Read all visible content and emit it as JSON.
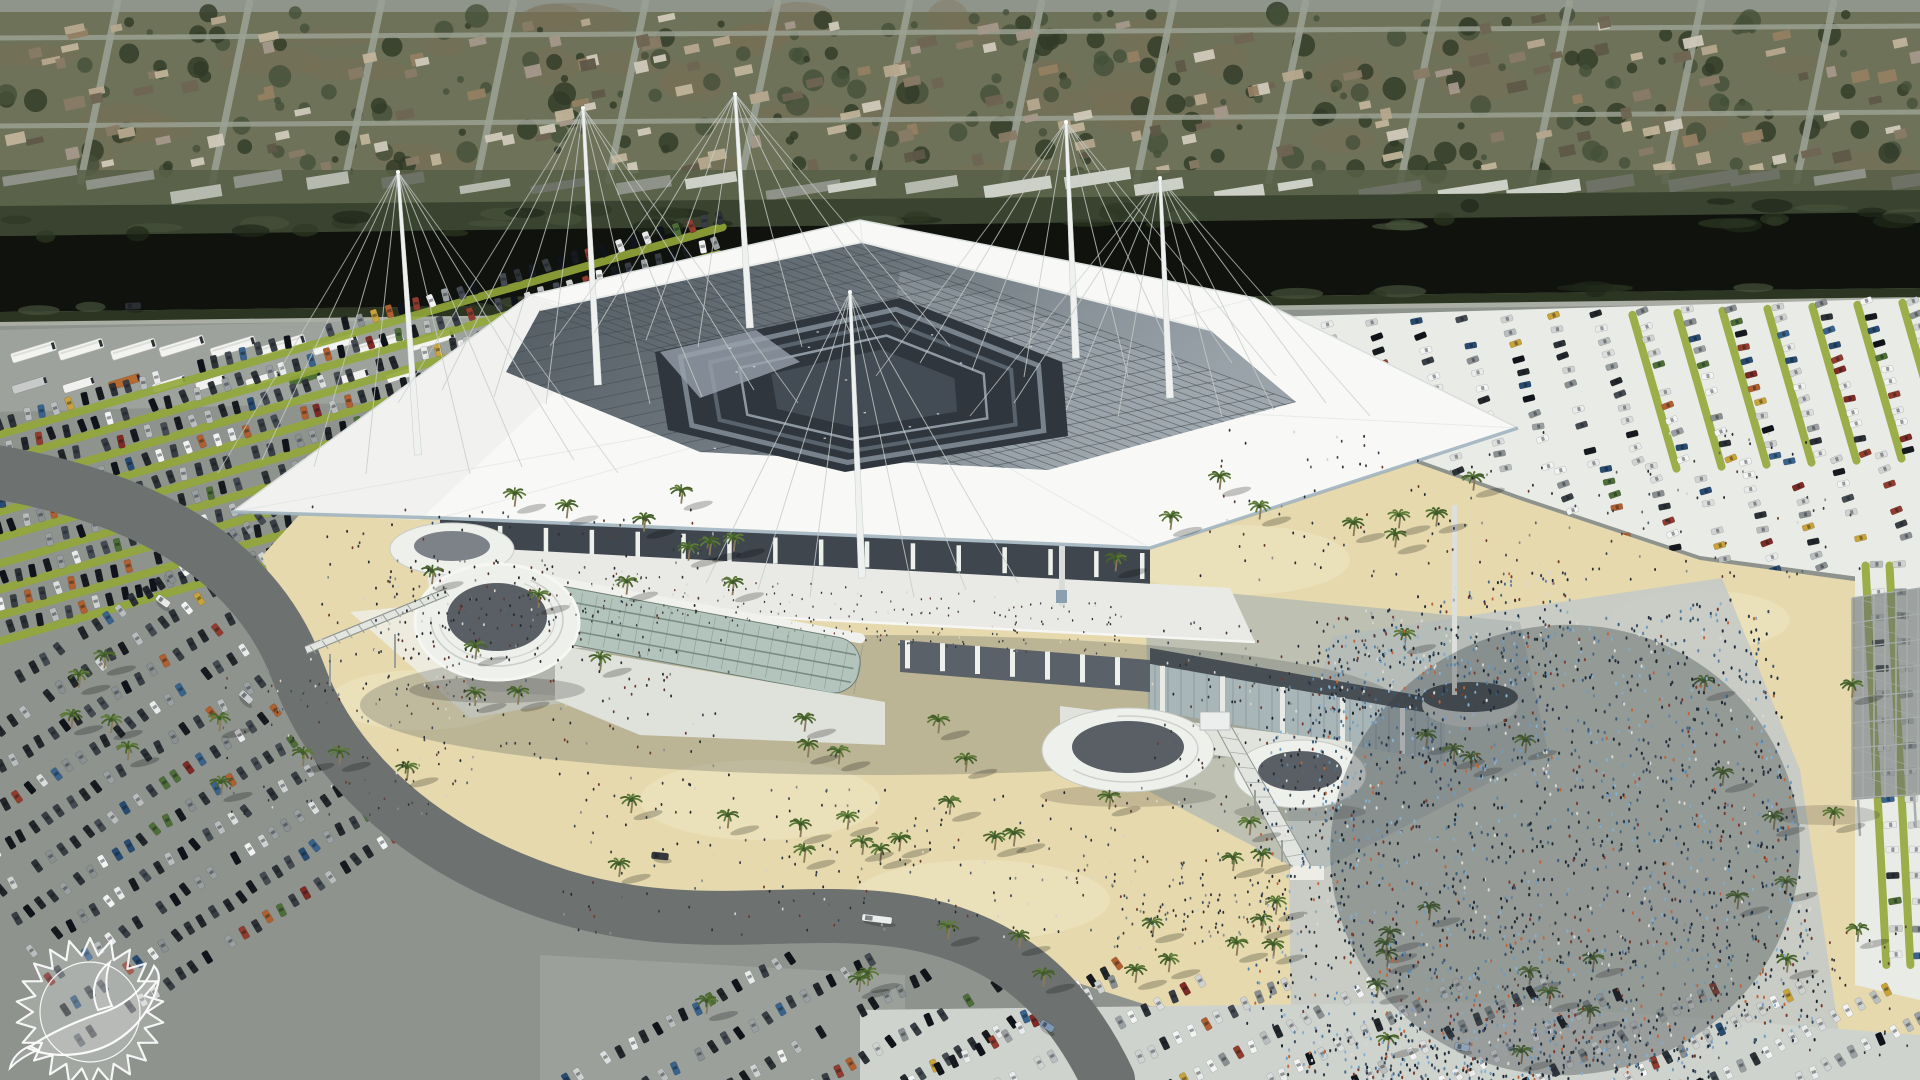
{
  "meta": {
    "title": "Aerial architectural rendering of a renovated Miami Dolphins stadium with white cable-stayed canopy roof, surrounded by parking lots, palm-lined sand plazas and event crowds",
    "team_logo": "miami-dolphins-sunburst-dolphin",
    "logo_style": "white outline watermark, bottom-left corner",
    "scene_type": "stadium-renovation-rendering"
  },
  "colors": {
    "neighborhood_base": "#6e7258",
    "neighborhood_patch": "#7a6d55",
    "tree1": "#45503a",
    "tree2": "#303a27",
    "street": "#9ba193",
    "highway": "#8f958b",
    "commercial_strip": "#575f47",
    "canal_brush": "#3a432f",
    "canal_brush_dark": "#2c3522",
    "canal_water": "#10130d",
    "service_road": "#a9ada3",
    "asphalt": "#8e938e",
    "asphalt_light": "#9da29d",
    "lot_light": "#e9ebe6",
    "lot_mid": "#cfd3cd",
    "lot_gray": "#9ba09b",
    "grass_strip": "#93a839",
    "sand": "#e5d9ad",
    "sand_light": "#efe7c6",
    "plaza_concrete": "#eeede5",
    "plaza_shade": "#aeb6b3",
    "crowd_pavement": "#c6cbc6",
    "road": "#6d7271",
    "canopy": "#f8f9f6",
    "canopy_shade": "#eef0ee",
    "canopy_fascia": "#9db0bc",
    "canopy_line": "#d3d8d6",
    "gridroof_dark": "#565e66",
    "grid_line": "#3d444b",
    "bowl": "#2f363d",
    "bowl_band1": "#78828c",
    "bowl_band2": "#59636d",
    "bowl_band3": "#8e98a2",
    "facade_dark": "#3f464e",
    "facade_col": "#eef0ec",
    "deck": "#e9eae6",
    "glass": "#b3c4bd",
    "glass_line": "#6d7f76",
    "glass2": "#a9b6b8",
    "base_white": "#dfe1db",
    "cap": "#474e54",
    "mast": "#eef1ef",
    "cable": "#c6ccc9",
    "ramp_white": "#eef0ec",
    "ramp_inner": "#595f64",
    "ramp_line": "#c3c7c2",
    "scaffold": "#a8aeac",
    "scaffold_dark": "#6a7070",
    "palm_frond": "#5d7a38",
    "palm_frond2": "#47622c",
    "palm_trunk": "#8a7a5c",
    "logo_white": "#ffffff"
  },
  "neighborhood": {
    "house_count": 190,
    "tree_count": 250,
    "street_count": 16,
    "commercial_count": 26,
    "house_palette": [
      "#b5a88e",
      "#937f63",
      "#cfc9bb",
      "#6e6452",
      "#a3988a",
      "#887b66",
      "#5e5748",
      "#c0b49a"
    ],
    "commercial_palette": [
      "#cdd0c6",
      "#b5b9ae",
      "#8e9288",
      "#6d7166"
    ]
  },
  "buses": {
    "row1_count": 21,
    "row2_count": 22
  },
  "vehicles": {
    "palettes": {
      "dark": [
        "#23272b",
        "#2d3237",
        "#383e44",
        "#171b1f",
        "#454b52",
        "#10141a"
      ],
      "light": [
        "#e9eaea",
        "#f2f3f2",
        "#dcdedd",
        "#cfd2d1"
      ],
      "silver": [
        "#b9bdbd",
        "#9aa0a2",
        "#8a9092"
      ],
      "accent": [
        "#7e2b26",
        "#913c2e",
        "#274b71",
        "#3a638c",
        "#b06030",
        "#4e6e38",
        "#c8a23a"
      ]
    },
    "road_cars": [
      {
        "x": 133,
        "y": 306,
        "a": -2,
        "c": "#2a2e33",
        "len": 16
      },
      {
        "x": 163,
        "y": 601,
        "a": 36,
        "c": "#e8e9e7",
        "len": 15
      },
      {
        "x": 246,
        "y": 697,
        "a": 42,
        "c": "#c9cdce",
        "len": 15
      },
      {
        "x": 660,
        "y": 856,
        "a": 6,
        "c": "#34383c",
        "len": 17
      },
      {
        "x": 877,
        "y": 919,
        "a": 7,
        "c": "#eceeee",
        "len": 30
      },
      {
        "x": 1047,
        "y": 1026,
        "a": 32,
        "c": "#7e98b4",
        "len": 15
      },
      {
        "x": 1462,
        "y": 1047,
        "a": 12,
        "c": "#8fa3b8",
        "len": 15
      }
    ]
  },
  "lots": [
    {
      "name": "upper-left",
      "x0": -30,
      "y0": 432,
      "angle": -16,
      "rows": 9,
      "gapX": -4,
      "gapY": 27,
      "len": 780,
      "spacing": 15,
      "mix": "dark",
      "grass": true,
      "carW": 13,
      "carH": 6.5
    },
    {
      "name": "lower-left",
      "x0": -80,
      "y0": 740,
      "angle": -33,
      "rows": 11,
      "gapX": 16,
      "gapY": 30,
      "len": 520,
      "spacing": 15,
      "mix": "dark",
      "grass": false,
      "carW": 13,
      "carH": 6.5
    },
    {
      "name": "top-right",
      "x0": 1192,
      "y0": 332,
      "angle": 74,
      "rows": 17,
      "gapX": 45,
      "gapY": -2,
      "len": 160,
      "spacing": 14,
      "mix": "mixed",
      "grass": true,
      "grassAfter": 10,
      "carW": 12,
      "carH": 6
    },
    {
      "name": "top-right-lower",
      "x0": 1560,
      "y0": 470,
      "angle": 74,
      "rows": 8,
      "gapX": 46,
      "gapY": -2,
      "len": 120,
      "spacing": 14,
      "mix": "mixed",
      "grass": false,
      "carW": 12,
      "carH": 6
    }
  ],
  "lots_south": [
    {
      "name": "bottom-center",
      "x0": 540,
      "y0": 1095,
      "angle": -29,
      "rows": 5,
      "gapX": 82,
      "gapY": 2,
      "len": 290,
      "spacing": 15,
      "mix": "dark",
      "grass": false,
      "carW": 13,
      "carH": 6.5
    },
    {
      "name": "bottom-right",
      "x0": 900,
      "y0": 1090,
      "angle": -27,
      "rows": 11,
      "gapX": 86,
      "gapY": 1,
      "len": 240,
      "spacing": 15,
      "mix": "light",
      "grass": false,
      "carW": 13,
      "carH": 6.5
    },
    {
      "name": "right-edge",
      "x0": 1876,
      "y0": 565,
      "angle": 87,
      "rows": 2,
      "gapX": 24,
      "gapY": 0,
      "len": 400,
      "spacing": 26,
      "mix": "light",
      "grass": true,
      "carW": 13,
      "carH": 6.5
    }
  ],
  "palms": {
    "clusters": [
      {
        "cx": 500,
        "cy": 640,
        "w": 380,
        "h": 300,
        "n": 13
      },
      {
        "cx": 150,
        "cy": 705,
        "w": 170,
        "h": 150,
        "n": 5
      },
      {
        "cx": 255,
        "cy": 775,
        "w": 120,
        "h": 90,
        "n": 3
      },
      {
        "cx": 955,
        "cy": 842,
        "w": 820,
        "h": 70,
        "n": 16
      },
      {
        "cx": 905,
        "cy": 975,
        "w": 560,
        "h": 80,
        "n": 9
      },
      {
        "cx": 1295,
        "cy": 950,
        "w": 290,
        "h": 90,
        "n": 6
      },
      {
        "cx": 1330,
        "cy": 520,
        "w": 430,
        "h": 120,
        "n": 9
      },
      {
        "cx": 1620,
        "cy": 985,
        "w": 520,
        "h": 160,
        "n": 11
      },
      {
        "cx": 1800,
        "cy": 795,
        "w": 210,
        "h": 240,
        "n": 7
      },
      {
        "cx": 860,
        "cy": 762,
        "w": 260,
        "h": 70,
        "n": 5
      },
      {
        "cx": 1470,
        "cy": 705,
        "w": 190,
        "h": 150,
        "n": 5
      },
      {
        "cx": 700,
        "cy": 560,
        "w": 160,
        "h": 120,
        "n": 4
      }
    ]
  },
  "crowds": {
    "palettes": {
      "mixed": [
        "#262d36",
        "#323b47",
        "#3e4e60",
        "#4c6a86",
        "#5d84a6",
        "#6f9cc0",
        "#86b2d2",
        "#2b3540",
        "#263142",
        "#7c3b2f",
        "#c06538",
        "#d8d8d4",
        "#3a5a7a",
        "#203040",
        "#8aa8c4",
        "#1c242e"
      ],
      "dark": [
        "#2c2f33",
        "#3a3e43",
        "#56423a",
        "#6e3a30",
        "#8a8f8a",
        "#24282c",
        "#404a56",
        "#d6d3c9",
        "#5c646e",
        "#31363b"
      ]
    },
    "clusters": [
      {
        "cx": 1565,
        "cy": 850,
        "w": 470,
        "h": 450,
        "rot": -8,
        "n": 1900,
        "p": "mixed",
        "r": 1.5
      },
      {
        "cx": 1450,
        "cy": 645,
        "w": 260,
        "h": 110,
        "rot": -14,
        "n": 260,
        "p": "mixed",
        "r": 1.4
      },
      {
        "cx": 1495,
        "cy": 1055,
        "w": 430,
        "h": 60,
        "rot": 0,
        "n": 240,
        "p": "mixed",
        "r": 1.5
      },
      {
        "cx": 1302,
        "cy": 850,
        "w": 90,
        "h": 360,
        "rot": 4,
        "n": 200,
        "p": "mixed",
        "r": 1.4
      },
      {
        "cx": 520,
        "cy": 645,
        "w": 420,
        "h": 290,
        "rot": 0,
        "n": 230,
        "p": "dark",
        "r": 1.3
      },
      {
        "cx": 462,
        "cy": 610,
        "w": 180,
        "h": 100,
        "rot": 0,
        "n": 120,
        "p": "dark",
        "r": 1.3
      },
      {
        "cx": 950,
        "cy": 862,
        "w": 780,
        "h": 150,
        "rot": 0,
        "n": 250,
        "p": "dark",
        "r": 1.3
      },
      {
        "cx": 1530,
        "cy": 505,
        "w": 660,
        "h": 150,
        "rot": 0,
        "n": 150,
        "p": "dark",
        "r": 1.3
      },
      {
        "cx": 1265,
        "cy": 715,
        "w": 230,
        "h": 190,
        "rot": 0,
        "n": 120,
        "p": "dark",
        "r": 1.3
      },
      {
        "cx": 830,
        "cy": 612,
        "w": 600,
        "h": 55,
        "rot": 4,
        "n": 240,
        "p": "dark",
        "r": 1.05
      },
      {
        "cx": 1700,
        "cy": 990,
        "w": 420,
        "h": 140,
        "rot": 0,
        "n": 130,
        "p": "dark",
        "r": 1.3
      },
      {
        "cx": 350,
        "cy": 740,
        "w": 260,
        "h": 160,
        "rot": 0,
        "n": 90,
        "p": "dark",
        "r": 1.2
      },
      {
        "cx": 1190,
        "cy": 905,
        "w": 160,
        "h": 90,
        "rot": 0,
        "n": 90,
        "p": "dark",
        "r": 1.3
      }
    ]
  },
  "logo": {
    "cx": 90,
    "cy": 1012,
    "outer_r": 74,
    "inner_r": 57,
    "spikes": 22
  }
}
